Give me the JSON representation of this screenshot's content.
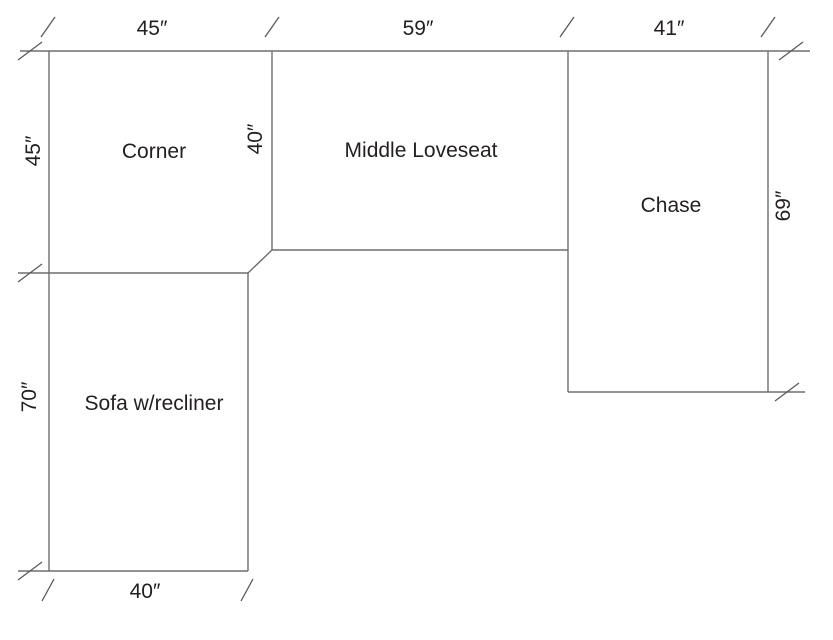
{
  "diagram": {
    "type": "sectional-sofa-floor-plan",
    "background": "#ffffff",
    "line_color": "#6d6e70",
    "text_color": "#231f20"
  },
  "pieces": {
    "corner": {
      "label": "Corner"
    },
    "middle_loveseat": {
      "label": "Middle Loveseat"
    },
    "chase": {
      "label": "Chase"
    },
    "sofa_recliner": {
      "label": "Sofa w/recliner"
    }
  },
  "dimensions": {
    "corner_width_top": "45″",
    "loveseat_width_top": "59″",
    "chase_width_top": "41″",
    "corner_depth_left": "45″",
    "sofa_length_left": "70″",
    "loveseat_depth_middle": "40″",
    "chase_length_right": "69″",
    "sofa_width_bottom": "40″"
  }
}
